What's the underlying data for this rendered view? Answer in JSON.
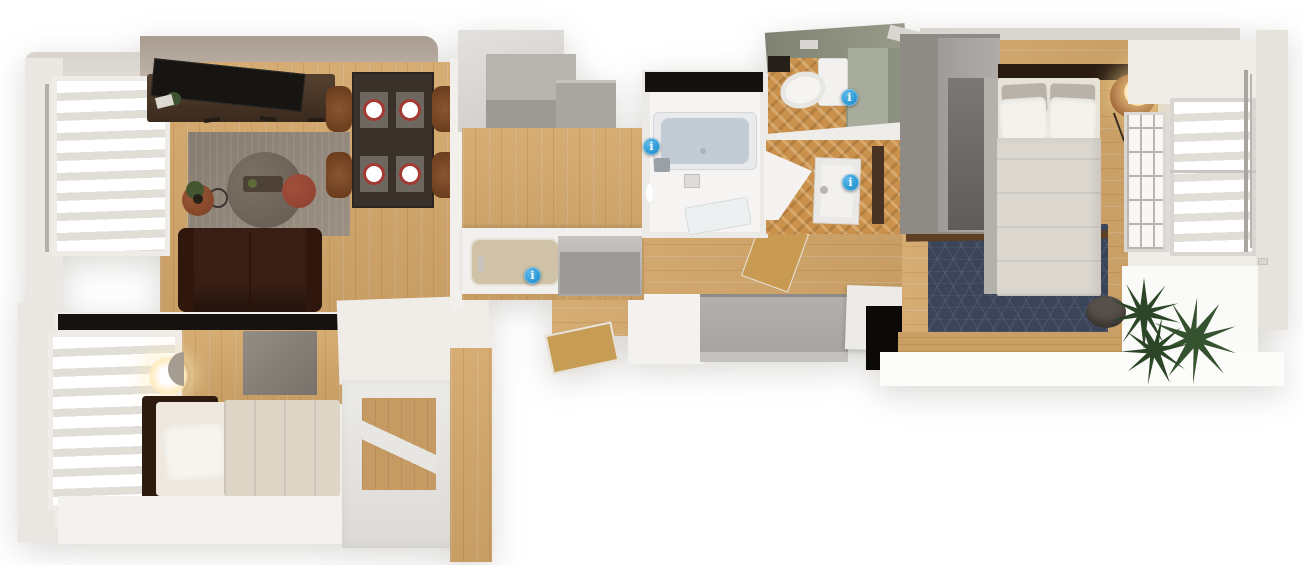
{
  "meta": {
    "view": "top-down-3d-floorplan-render",
    "background": "#ffffff"
  },
  "rooms": [
    {
      "id": "living-dining",
      "label": "living-dining room"
    },
    {
      "id": "kitchen",
      "label": "kitchen"
    },
    {
      "id": "bathroom",
      "label": "bathroom with tub"
    },
    {
      "id": "toilet",
      "label": "toilet room"
    },
    {
      "id": "washroom",
      "label": "washroom closet"
    },
    {
      "id": "hallway-entrance",
      "label": "hallway and entrance"
    },
    {
      "id": "bedroom-master",
      "label": "master bedroom"
    },
    {
      "id": "bedroom-small",
      "label": "small bedroom"
    },
    {
      "id": "balcony",
      "label": "balcony"
    }
  ],
  "markers": {
    "glyph": "i",
    "items": [
      {
        "id": "kitchen",
        "x": 533,
        "y": 276
      },
      {
        "id": "bathroom",
        "x": 652,
        "y": 147
      },
      {
        "id": "toilet",
        "x": 850,
        "y": 98
      },
      {
        "id": "washroom",
        "x": 851,
        "y": 183
      }
    ]
  },
  "palette": {
    "marker_blue": "#2e9ad5",
    "wood_light": "#d6ab6e",
    "wood_mid": "#cfa263",
    "wood_dark": "#c9914b",
    "navy_rug": "#3b4559",
    "sofa_brown": "#3a1f14",
    "accent_red": "#8f4030",
    "sage": "#a8ac9c",
    "sage_dark": "#8e9081",
    "bathtub": "#c3ccd5",
    "wall_light": "#f0ede9",
    "wall_beige": "#b4a89c",
    "black_trim": "#15120f",
    "plant_green": "#2e4827",
    "plate_red": "#a23a34",
    "chair_brown": "#7c4a26",
    "rug_gray": "#968a7d",
    "counter_white": "#f1f0ee",
    "genkan_gray": "#a9a7a4"
  }
}
